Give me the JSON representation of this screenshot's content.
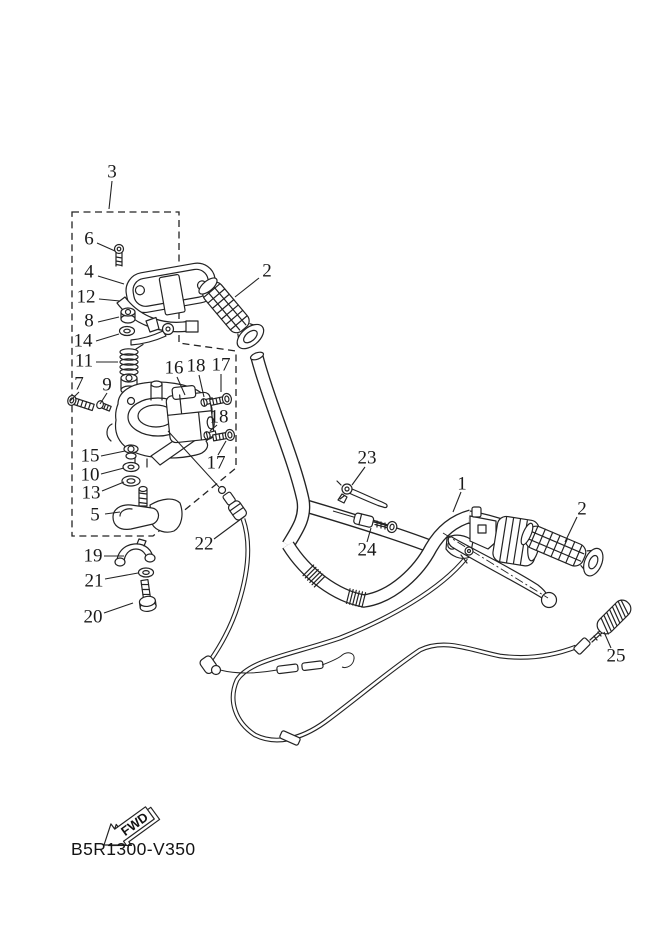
{
  "diagram": {
    "part_code": "B5R1300-V350",
    "fwd_label": "FWD",
    "background": "#ffffff",
    "line_color": "#232323",
    "part_labels": [
      {
        "id": "3",
        "text": "3",
        "x": 112,
        "y": 172,
        "leader": [
          112,
          181,
          109,
          209
        ]
      },
      {
        "id": "6",
        "text": "6",
        "x": 89,
        "y": 239,
        "leader": [
          97,
          243,
          115,
          251
        ]
      },
      {
        "id": "4",
        "text": "4",
        "x": 89,
        "y": 272,
        "leader": [
          98,
          276,
          124,
          284
        ]
      },
      {
        "id": "12",
        "text": "12",
        "x": 86,
        "y": 297,
        "leader": [
          99,
          299,
          120,
          301
        ]
      },
      {
        "id": "8",
        "text": "8",
        "x": 89,
        "y": 321,
        "leader": [
          98,
          322,
          119,
          317
        ]
      },
      {
        "id": "14",
        "text": "14",
        "x": 83,
        "y": 341,
        "leader": [
          96,
          341,
          119,
          334
        ]
      },
      {
        "id": "11",
        "text": "11",
        "x": 84,
        "y": 361,
        "leader": [
          96,
          362,
          118,
          362
        ]
      },
      {
        "id": "7",
        "text": "7",
        "x": 79,
        "y": 384,
        "leader": [
          79,
          392,
          70,
          401
        ]
      },
      {
        "id": "9",
        "text": "9",
        "x": 107,
        "y": 385,
        "leader": [
          107,
          393,
          100,
          404
        ]
      },
      {
        "id": "16",
        "text": "16",
        "x": 174,
        "y": 368,
        "leader": [
          177,
          377,
          185,
          395
        ]
      },
      {
        "id": "18a",
        "text": "18",
        "x": 196,
        "y": 366,
        "leader": [
          199,
          375,
          204,
          397
        ]
      },
      {
        "id": "17a",
        "text": "17",
        "x": 221,
        "y": 365,
        "leader": [
          221,
          374,
          221,
          392
        ]
      },
      {
        "id": "18b",
        "text": "18",
        "x": 219,
        "y": 417,
        "leader": [
          217,
          425,
          210,
          431
        ]
      },
      {
        "id": "17b",
        "text": "17",
        "x": 216,
        "y": 463,
        "leader": [
          218,
          455,
          226,
          441
        ]
      },
      {
        "id": "15",
        "text": "15",
        "x": 90,
        "y": 456,
        "leader": [
          101,
          456,
          125,
          451
        ]
      },
      {
        "id": "10",
        "text": "10",
        "x": 90,
        "y": 475,
        "leader": [
          101,
          474,
          124,
          468
        ]
      },
      {
        "id": "13",
        "text": "13",
        "x": 91,
        "y": 493,
        "leader": [
          102,
          491,
          124,
          482
        ]
      },
      {
        "id": "5",
        "text": "5",
        "x": 95,
        "y": 515,
        "leader": [
          105,
          514,
          120,
          512
        ]
      },
      {
        "id": "19",
        "text": "19",
        "x": 93,
        "y": 556,
        "leader": [
          104,
          556,
          124,
          556
        ]
      },
      {
        "id": "21",
        "text": "21",
        "x": 94,
        "y": 581,
        "leader": [
          105,
          579,
          138,
          573
        ]
      },
      {
        "id": "20",
        "text": "20",
        "x": 93,
        "y": 617,
        "leader": [
          104,
          613,
          133,
          603
        ]
      },
      {
        "id": "22",
        "text": "22",
        "x": 204,
        "y": 544,
        "leader": [
          214,
          539,
          245,
          516
        ]
      },
      {
        "id": "23",
        "text": "23",
        "x": 367,
        "y": 458,
        "leader": [
          365,
          467,
          352,
          485
        ]
      },
      {
        "id": "24",
        "text": "24",
        "x": 367,
        "y": 550,
        "leader": [
          367,
          542,
          371,
          528
        ]
      },
      {
        "id": "1",
        "text": "1",
        "x": 462,
        "y": 484,
        "leader": [
          461,
          492,
          453,
          512
        ]
      },
      {
        "id": "2a",
        "text": "2",
        "x": 267,
        "y": 271,
        "leader": [
          259,
          278,
          235,
          297
        ]
      },
      {
        "id": "2b",
        "text": "2",
        "x": 582,
        "y": 509,
        "leader": [
          577,
          517,
          565,
          542
        ]
      },
      {
        "id": "25",
        "text": "25",
        "x": 616,
        "y": 656,
        "leader": [
          611,
          648,
          604,
          632
        ]
      }
    ]
  }
}
